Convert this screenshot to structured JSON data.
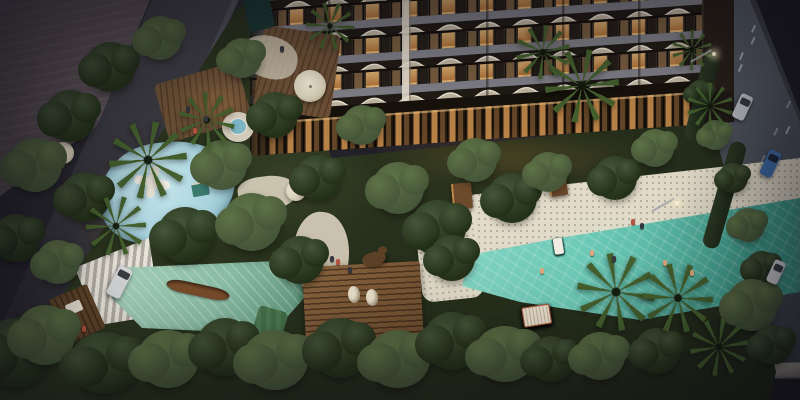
{
  "scene": {
    "type": "architectural-aerial-render",
    "time_of_day": "dusk",
    "description": "Aerial dusk rendering of a curved-balcony residential tower above a lit glass amenity podium, with a landscaped deck featuring a turquoise lap pool with in-water loungers, striped cabanas, a lagoon pool with cascade steps and a wooden canoe, a kids splash pad, spa, wood pergola deck with bear sculpture, outdoor dining terraces, palm trees and dense gardens, bordered by city streets with cars",
    "features": [
      "residential tower with wavy balconies",
      "lit glass podium",
      "main turquoise pool",
      "in-water sun loungers",
      "striped cabanas",
      "lagoon pool",
      "white cascade steps",
      "wooden canoe",
      "kids splash pad",
      "spa pool",
      "wood pergola deck",
      "bear sculpture",
      "lounge pods",
      "outdoor dining terrace",
      "umbrellas",
      "garden paths",
      "palm trees",
      "tree canopies",
      "left street with white van",
      "right road with cars and lane markings",
      "street lamps",
      "sidewalk"
    ]
  },
  "counts": {
    "pool_loungers": 10,
    "cabanas": 5,
    "tower_floors": 4,
    "cars": 4,
    "street_lamps": 2
  },
  "colors": {
    "night_base": "#24232a",
    "street_asphalt": "#3e3d45",
    "neighbor_roof": "#675c61",
    "road_light": "#575d66",
    "road_dark": "#383c42",
    "lane_marking": "#dde2e6",
    "sidewalk": "#9c978e",
    "bottom_street": "#222126",
    "garden_dark": "#242d1b",
    "garden_mid": "#2f3a22",
    "tree_dark": "#243119",
    "tree_mid": "#455639",
    "tree_light": "#5f7346",
    "palm_frond": "#45602e",
    "path_cream": "#d3cab6",
    "deck_cream": "#e2dbc9",
    "deck_dot": "#b1aa99",
    "splash_blue": "#a9d3dd",
    "lagoon_teal": "#8cc0a6",
    "pool_turquoise": "#6fcab8",
    "pool_deep": "#3f9f8d",
    "wood_deck": "#8a6540",
    "wood_dark": "#5e4429",
    "canoe_brown": "#7a4e2c",
    "lounger_white": "#f1ede2",
    "cabana_cream": "#e9e0cf",
    "cabana_frame": "#a55c3d",
    "balcony_cream": "#c6bba6",
    "balcony_edge": "#f0ead9",
    "slab_gray": "#83828a",
    "glass_dark": "#3a322a",
    "window_lit": "#e3a75f",
    "window_bright": "#f2c584",
    "podium_glass": "#c98f4e",
    "podium_dark": "#17120c",
    "glow_warm": "#ffaa55",
    "car_white": "#d6d7d9",
    "car_blue": "#3f6ca8",
    "car_silver": "#b8bcc2",
    "spa_blue": "#7fb9c9",
    "umbrella_cream": "#d9d0b8",
    "water_feature": "#1e3a36",
    "bear_brown": "#5e4228",
    "person_skin": "#e0a87c",
    "person_red": "#b5543e",
    "person_dark": "#36363e"
  }
}
